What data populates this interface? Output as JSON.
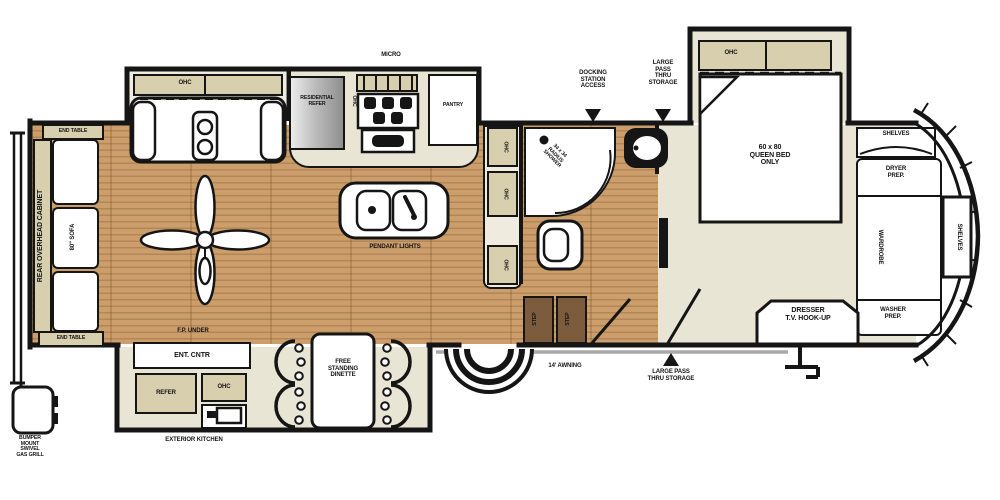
{
  "colors": {
    "wall": "#151515",
    "wood_floor": "#c89963",
    "carpet_floor": "#e9e5d4",
    "cabinet_tan": "#d7cfae",
    "step_brown": "#7d5c3e",
    "awning_gray": "#a9a9a9"
  },
  "areas": {
    "rear": {
      "end_table_top": "END TABLE",
      "end_table_bottom": "END TABLE",
      "overhead_cabinet": "REAR OVERHEAD CABINET",
      "sofa": "80\" SOFA",
      "gas_grill": "BUMPER\nMOUNT\nSWIVEL\nGAS GRILL"
    },
    "living": {
      "theater_ohc": "OHC",
      "pendant_lights": "PENDANT LIGHTS"
    },
    "kitchen": {
      "micro": "MICRO",
      "residential_refer": "RESIDENTIAL\nREFER",
      "range_ohc": "OHC",
      "pantry": "PANTRY",
      "counter_ohc": [
        "OHC",
        "OHC",
        "OHC"
      ]
    },
    "bath": {
      "shower": "34 x 34\nRADIUS\nSHOWER"
    },
    "steps": {
      "step_left": "STEP",
      "step_right": "STEP"
    },
    "dinette": {
      "label": "FREE\nSTANDING\nDINETTE"
    },
    "exterior": {
      "docking_station": "DOCKING\nSTATION\nACCESS",
      "pass_thru_top": "LARGE\nPASS\nTHRU\nSTORAGE",
      "pass_thru_bottom": "LARGE PASS\nTHRU STORAGE",
      "awning": "14' AWNING",
      "fp_under": "F.P. UNDER",
      "ent_cntr": "ENT. CNTR",
      "refer": "REFER",
      "ohc": "OHC",
      "exterior_kitchen": "EXTERIOR KITCHEN"
    },
    "bedroom": {
      "ohc": "OHC",
      "bed": "60 x 80\nQUEEN BED\nONLY",
      "dresser": "DRESSER\nT.V. HOOK-UP"
    },
    "front": {
      "shelves_top": "SHELVES",
      "dryer_prep": "DRYER\nPREP.",
      "wardrobe": "WARDROBE",
      "shelves_side": "SHELVES",
      "washer_prep": "WASHER\nPREP."
    }
  }
}
